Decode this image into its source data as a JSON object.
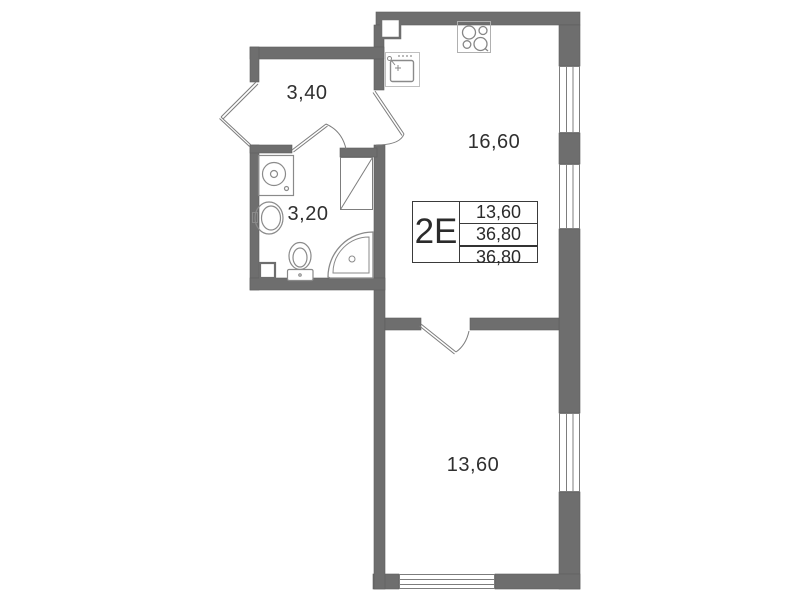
{
  "plan": {
    "unit": {
      "type_label": "2Е",
      "area_rows": [
        "13,60",
        "36,80",
        "36,80"
      ]
    },
    "room_labels": {
      "hallway": "3,40",
      "bathroom": "3,20",
      "kitchen_living": "16,60",
      "bedroom": "13,60"
    },
    "icons": {
      "stove": "4-burner-hob",
      "kitchen_sink": "square-sink-with-faucet",
      "washing_machine": "square-with-drum-circle",
      "bath_sink": "oval-basin",
      "toilet": "bowl-with-tank",
      "shower": "corner-quarter-round-tray",
      "window": "triple-line-glazing",
      "door": "leaf-with-swing-arc",
      "vent": "rect-with-diagonal"
    },
    "colors": {
      "wall": "#6e6e6e",
      "thin_line": "#8a8a8a",
      "text": "#2f2f2f"
    }
  }
}
